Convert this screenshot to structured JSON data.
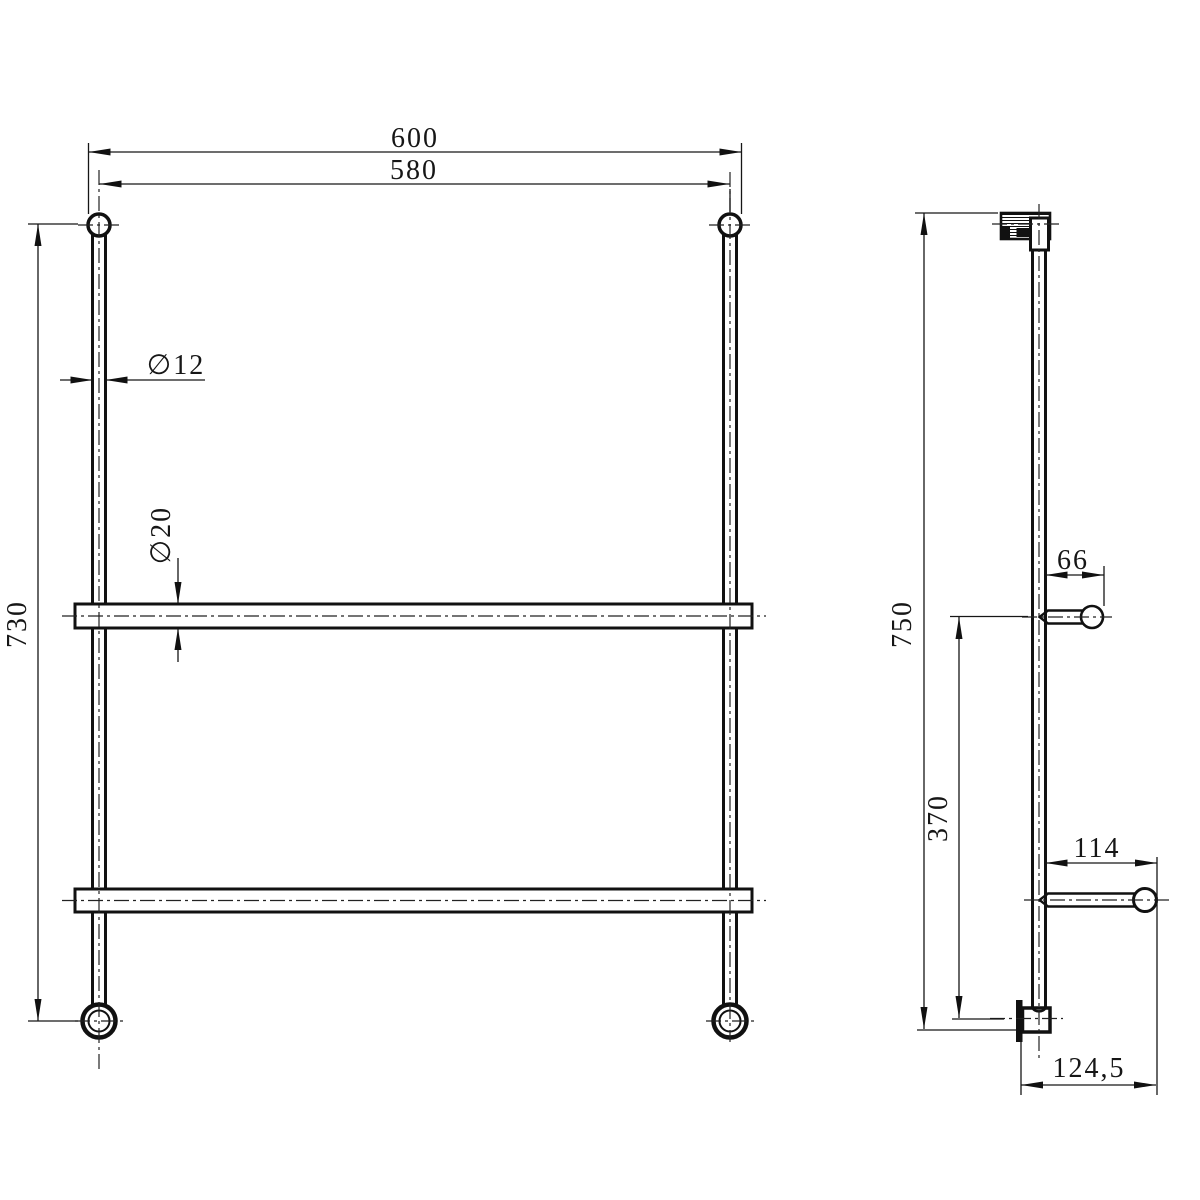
{
  "drawing": {
    "type": "technical-dimension-drawing",
    "subject": "double towel bar rack, front and side orthographic views",
    "colors": {
      "ink": "#111111",
      "background": "#ffffff"
    },
    "views": {
      "front": {
        "dims": {
          "overall_width": "600",
          "center_width": "580",
          "height": "730",
          "post_diameter": "∅12",
          "bar_diameter": "∅20"
        }
      },
      "side": {
        "dims": {
          "overall_height": "750",
          "upper_hook_depth": "66",
          "hook_vertical_spacing": "370",
          "lower_hook_depth": "114",
          "bottom_depth": "124,5"
        }
      }
    }
  }
}
